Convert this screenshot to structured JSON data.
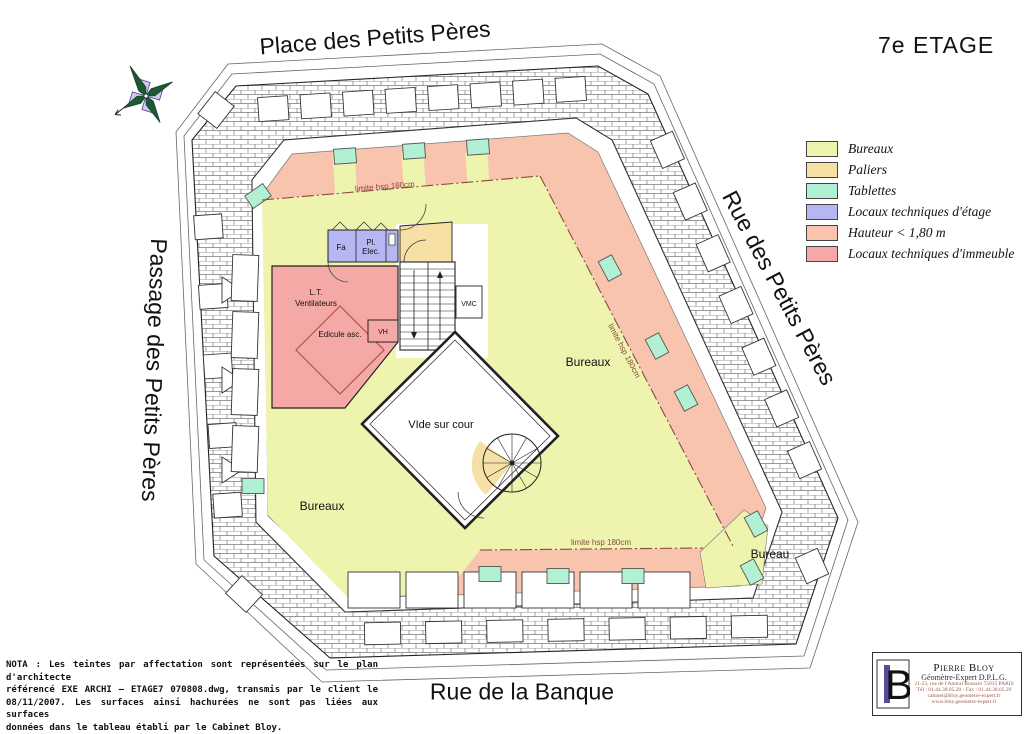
{
  "title": "7e ETAGE",
  "streets": {
    "top": "Place des Petits Pères",
    "right": "Rue des Petits Pères",
    "left": "Passage des Petits Pères",
    "bottom": "Rue de la Banque"
  },
  "legend": {
    "items": [
      {
        "key": "bureaux",
        "label": "Bureaux",
        "color": "#eef3ae"
      },
      {
        "key": "paliers",
        "label": "Paliers",
        "color": "#f7e0a6"
      },
      {
        "key": "tablettes",
        "label": "Tablettes",
        "color": "#b2f0d3"
      },
      {
        "key": "lt_etage",
        "label": "Locaux techniques d'étage",
        "color": "#b6b7f2"
      },
      {
        "key": "hauteur",
        "label": "Hauteur < 1,80 m",
        "color": "#f8c4ae"
      },
      {
        "key": "lt_immeuble",
        "label": "Locaux techniques d'immeuble",
        "color": "#f5a9a6"
      }
    ]
  },
  "plan": {
    "labels": {
      "bureaux_right": "Bureaux",
      "bureaux_left": "Bureaux",
      "bureau_bottom": "Bureau",
      "vide": "VIde sur cour",
      "limite": "limite hsp 180cm",
      "fa": "Fa",
      "pl": "Pl.",
      "elec": "Elec.",
      "lt": "L.T.",
      "ventilateurs": "Ventilateurs",
      "edicule": "Edicule asc.",
      "vh": "VH",
      "vmc": "VMC"
    }
  },
  "nota": {
    "line1": "NOTA : Les teintes par affectation sont représentées sur le plan d'architecte",
    "line2": "référencé EXE ARCHI — ETAGE7 070808.dwg, transmis par le client le",
    "line3": "08/11/2007. Les surfaces ainsi hachurées ne sont pas liées aux surfaces",
    "line4": "données dans le tableau établi par le Cabinet Bloy."
  },
  "stamp": {
    "monogram": "B",
    "name": "Pierre Bloy",
    "title": "Géomètre-Expert D.P.L.G.",
    "address": "21-23, rue de l'Amiral Roussin 75015 PARIS",
    "phone": "Tél : 01.44.38.05.20 - Fax : 01.44.38.05.20",
    "email": "cabinet@bloy.geometre-expert.fr",
    "web": "www.bloy.geometre-expert.fr"
  }
}
